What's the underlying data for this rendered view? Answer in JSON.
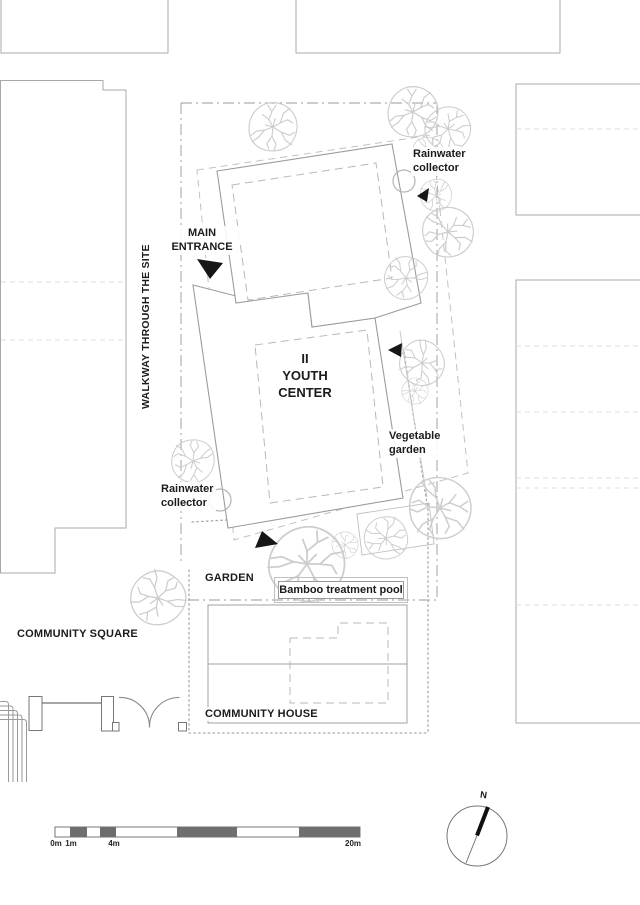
{
  "labels": {
    "walkway": "WALKWAY THROUGH THE SITE",
    "main_entrance": [
      "MAIN",
      "ENTRANCE"
    ],
    "rainwater_top": [
      "Rainwater",
      "collector"
    ],
    "rainwater_bottom": [
      "Rainwater",
      "collector"
    ],
    "youth_center": [
      "II",
      "YOUTH",
      "CENTER"
    ],
    "vegetable_garden": [
      "Vegetable",
      "garden"
    ],
    "garden": "GARDEN",
    "bamboo_pool": "Bamboo treatment pool",
    "community_square": "COMMUNITY SQUARE",
    "community_house": "COMMUNITY HOUSE",
    "north": "N"
  },
  "scale_bar": {
    "tick_0": "0m",
    "tick_1": "1m",
    "tick_4": "4m",
    "tick_20": "20m"
  },
  "icons": {
    "north_compass": "compass-icon",
    "entrance_arrow": "triangle-arrow-icon",
    "tree": "tree-icon",
    "rainwater_collector": "collector-arc-icon"
  },
  "colors": {
    "neighbor_building_stroke": "#a8a8a8",
    "youth_building_stroke": "#9c9c9c",
    "inner_dash": "#b8b8b8",
    "light_dash": "#dddddd",
    "boundary": "#999999",
    "dotted": "#aaaaaa",
    "platform_dash": "#c2c2c2",
    "tree": "#cdcdcd",
    "arrow": "#161616",
    "scale_dark": "#6e6e6e",
    "text": "#1b1b1b"
  }
}
